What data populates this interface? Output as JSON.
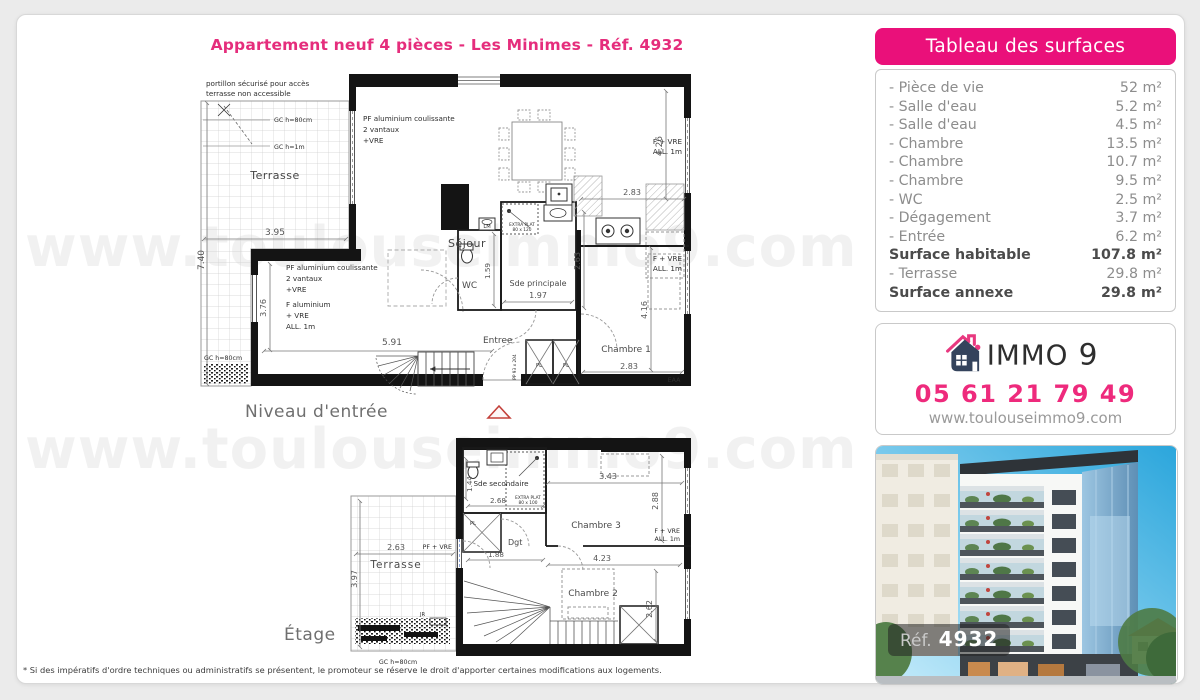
{
  "page": {
    "title": "Appartement neuf 4 pièces - Les Minimes - Réf. 4932",
    "watermark": "www.toulouseimmo9.com",
    "disclaimer": "* Si des impératifs d'ordre techniques ou administratifs se présentent, le promoteur se réserve le droit d'apporter certaines modifications aux logements."
  },
  "colors": {
    "accent_pink": "#ea107a",
    "navy": "#3c4b64",
    "text_gray": "#8d8d8d"
  },
  "surfaces": {
    "header": "Tableau des surfaces",
    "rows": [
      {
        "label": "- Pièce de vie",
        "value": "52 m²"
      },
      {
        "label": "- Salle d'eau",
        "value": "5.2 m²"
      },
      {
        "label": "- Salle d'eau",
        "value": "4.5 m²"
      },
      {
        "label": "- Chambre",
        "value": "13.5 m²"
      },
      {
        "label": "- Chambre",
        "value": "10.7 m²"
      },
      {
        "label": "- Chambre",
        "value": "9.5 m²"
      },
      {
        "label": "- WC",
        "value": "2.5 m²"
      },
      {
        "label": "- Dégagement",
        "value": "3.7 m²"
      },
      {
        "label": "- Entrée",
        "value": "6.2 m²"
      },
      {
        "label": "Surface habitable",
        "value": "107.8 m²"
      },
      {
        "label": "- Terrasse",
        "value": "29.8 m²"
      },
      {
        "label": "Surface annexe",
        "value": "29.8 m²"
      }
    ]
  },
  "agency": {
    "brand_immo": "IMMO",
    "brand_9": "9",
    "phone": "05 61 21 79 49",
    "website": "www.toulouseimmo9.com"
  },
  "photo": {
    "ref_label": "Réf.",
    "ref_number": "4932"
  },
  "plan_entry": {
    "labels": {
      "caption": "Niveau d'entrée",
      "portillon1": "portillon sécurisé pour accès",
      "portillon2": "terrasse non accessible",
      "gc80": "GC h=80cm",
      "gc1m": "GC h=1m",
      "terrasse": "Terrasse",
      "d395": "3.95",
      "d740": "7.40",
      "pf1": "PF aluminium coulissante",
      "pf2": "2 vantaux",
      "pf3": "+VRE",
      "sejour": "Séjour",
      "f_vre": "F + VRE",
      "all1m": "ALL. 1m",
      "d426": "4.26",
      "d283": "2.83",
      "d263": "2.63",
      "lm": "LM",
      "extra_a": "EXTRA PLAT",
      "extra_b": "80 x 120",
      "wc": "WC",
      "d159": "1.59",
      "sde": "Sde principale",
      "d197": "1.97",
      "entree": "Entree",
      "chambre1": "Chambre 1",
      "d416": "4.16",
      "eaa": "EAA",
      "falu1": "F aluminium",
      "falu2": "+ VRE",
      "falu3": "ALL. 1m",
      "d376": "3.76",
      "d591": "5.91",
      "pl": "PL",
      "pp": "PP 93 x 204"
    }
  },
  "plan_floor": {
    "labels": {
      "caption": "Étage",
      "sde2": "Sde secondaire",
      "d144": "1.44",
      "d268": "2.68",
      "extra_a": "EXTRA PLAT",
      "extra_b": "80 x 100",
      "d343": "3.43",
      "d288": "2.88",
      "chambre3": "Chambre 3",
      "f_vre": "F + VRE",
      "all1m": "ALL. 1m",
      "dgt": "Dgt",
      "d188": "1.88",
      "d423": "4.23",
      "chambre2": "Chambre 2",
      "d262": "2.62",
      "terrasse": "Terrasse",
      "d263": "2.63",
      "d397": "3.97",
      "pf_vre": "PF + VRE",
      "gc80": "GC h=80cm",
      "jr": "JR",
      "pl": "PL"
    }
  }
}
